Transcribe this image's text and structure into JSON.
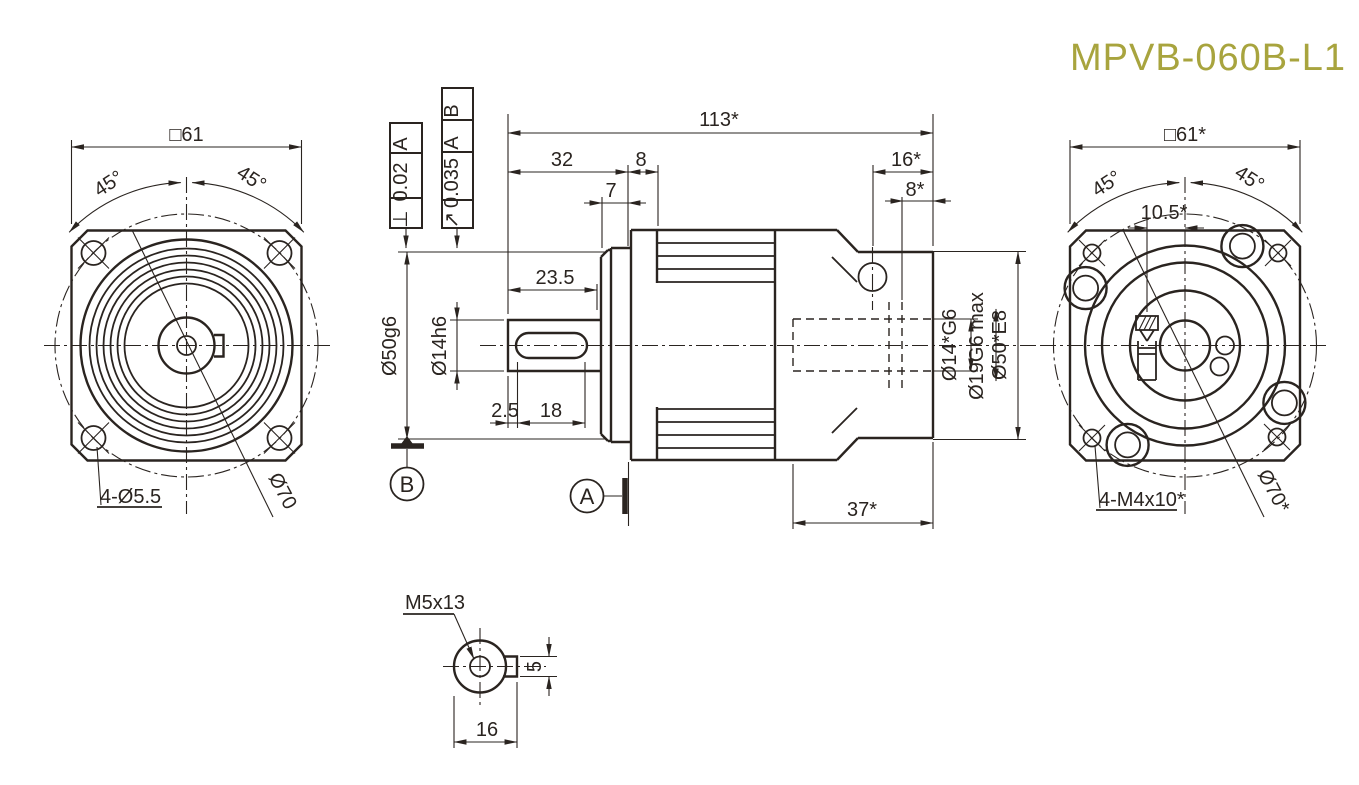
{
  "title": "MPVB-060B-L1",
  "colors": {
    "ink": "#2a2420",
    "accent": "#a8a43e",
    "background": "#ffffff"
  },
  "front_view": {
    "square_dim": "□61",
    "angle_left": "45°",
    "angle_right": "45°",
    "corner_holes": "4-Ø5.5",
    "bolt_circle": "Ø70"
  },
  "side_view": {
    "overall_length": "113*",
    "shaft_length": "32",
    "flange_step": "8",
    "pilot_depth": "7",
    "shaft_usable": "23.5",
    "key_offset": "2.5",
    "key_length": "18",
    "input_depth": "16*",
    "input_pilot_depth": "8*",
    "rear_length": "37*",
    "pilot_dia": "Ø50g6",
    "shaft_dia": "Ø14h6",
    "input_bore": "Ø14*G6",
    "input_bore_max": "Ø19G6 max",
    "input_recess": "Ø50*E8",
    "datum_a": "A",
    "datum_b": "B",
    "tolerance_perpendicularity": {
      "symbol": "⊥",
      "value": "0.02",
      "datum": "A"
    },
    "tolerance_runout": {
      "symbol": "↗",
      "value": "0.035",
      "datum_1": "A",
      "datum_2": "B"
    }
  },
  "rear_view": {
    "square_dim": "□61*",
    "angle_left": "45°",
    "angle_right": "45°",
    "clamp_offset": "10.5*",
    "corner_holes": "4-M4x10*",
    "bolt_circle": "Ø70*"
  },
  "detail_view": {
    "thread": "M5x13",
    "width": "16",
    "tab_height": "5"
  }
}
